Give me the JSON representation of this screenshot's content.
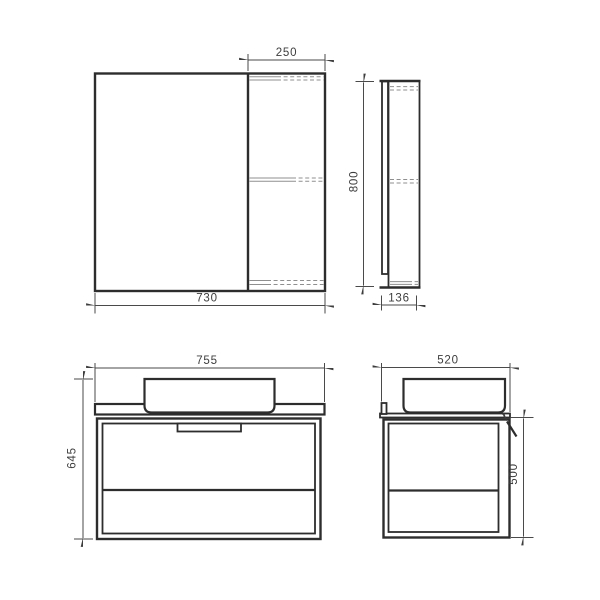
{
  "drawing": {
    "type": "technical-dimension-drawing",
    "subject": "bathroom furniture set (mirror cabinet and wall-hung vanity with countertop basin)",
    "units": "mm",
    "colors": {
      "background": "#ffffff",
      "main_line": "#2d2d2d",
      "thin_line": "#8f8f8f",
      "dimension_line": "#4a4a4a",
      "text": "#3d3d3d"
    },
    "views": {
      "mirror_front": {
        "shelf_section_width_label": "250",
        "total_width_label": "730"
      },
      "mirror_side": {
        "height_label": "800",
        "depth_label": "136"
      },
      "vanity_front": {
        "total_width_label": "755",
        "total_height_label": "645"
      },
      "vanity_side": {
        "depth_label": "520",
        "cabinet_height_label": "500"
      }
    }
  }
}
